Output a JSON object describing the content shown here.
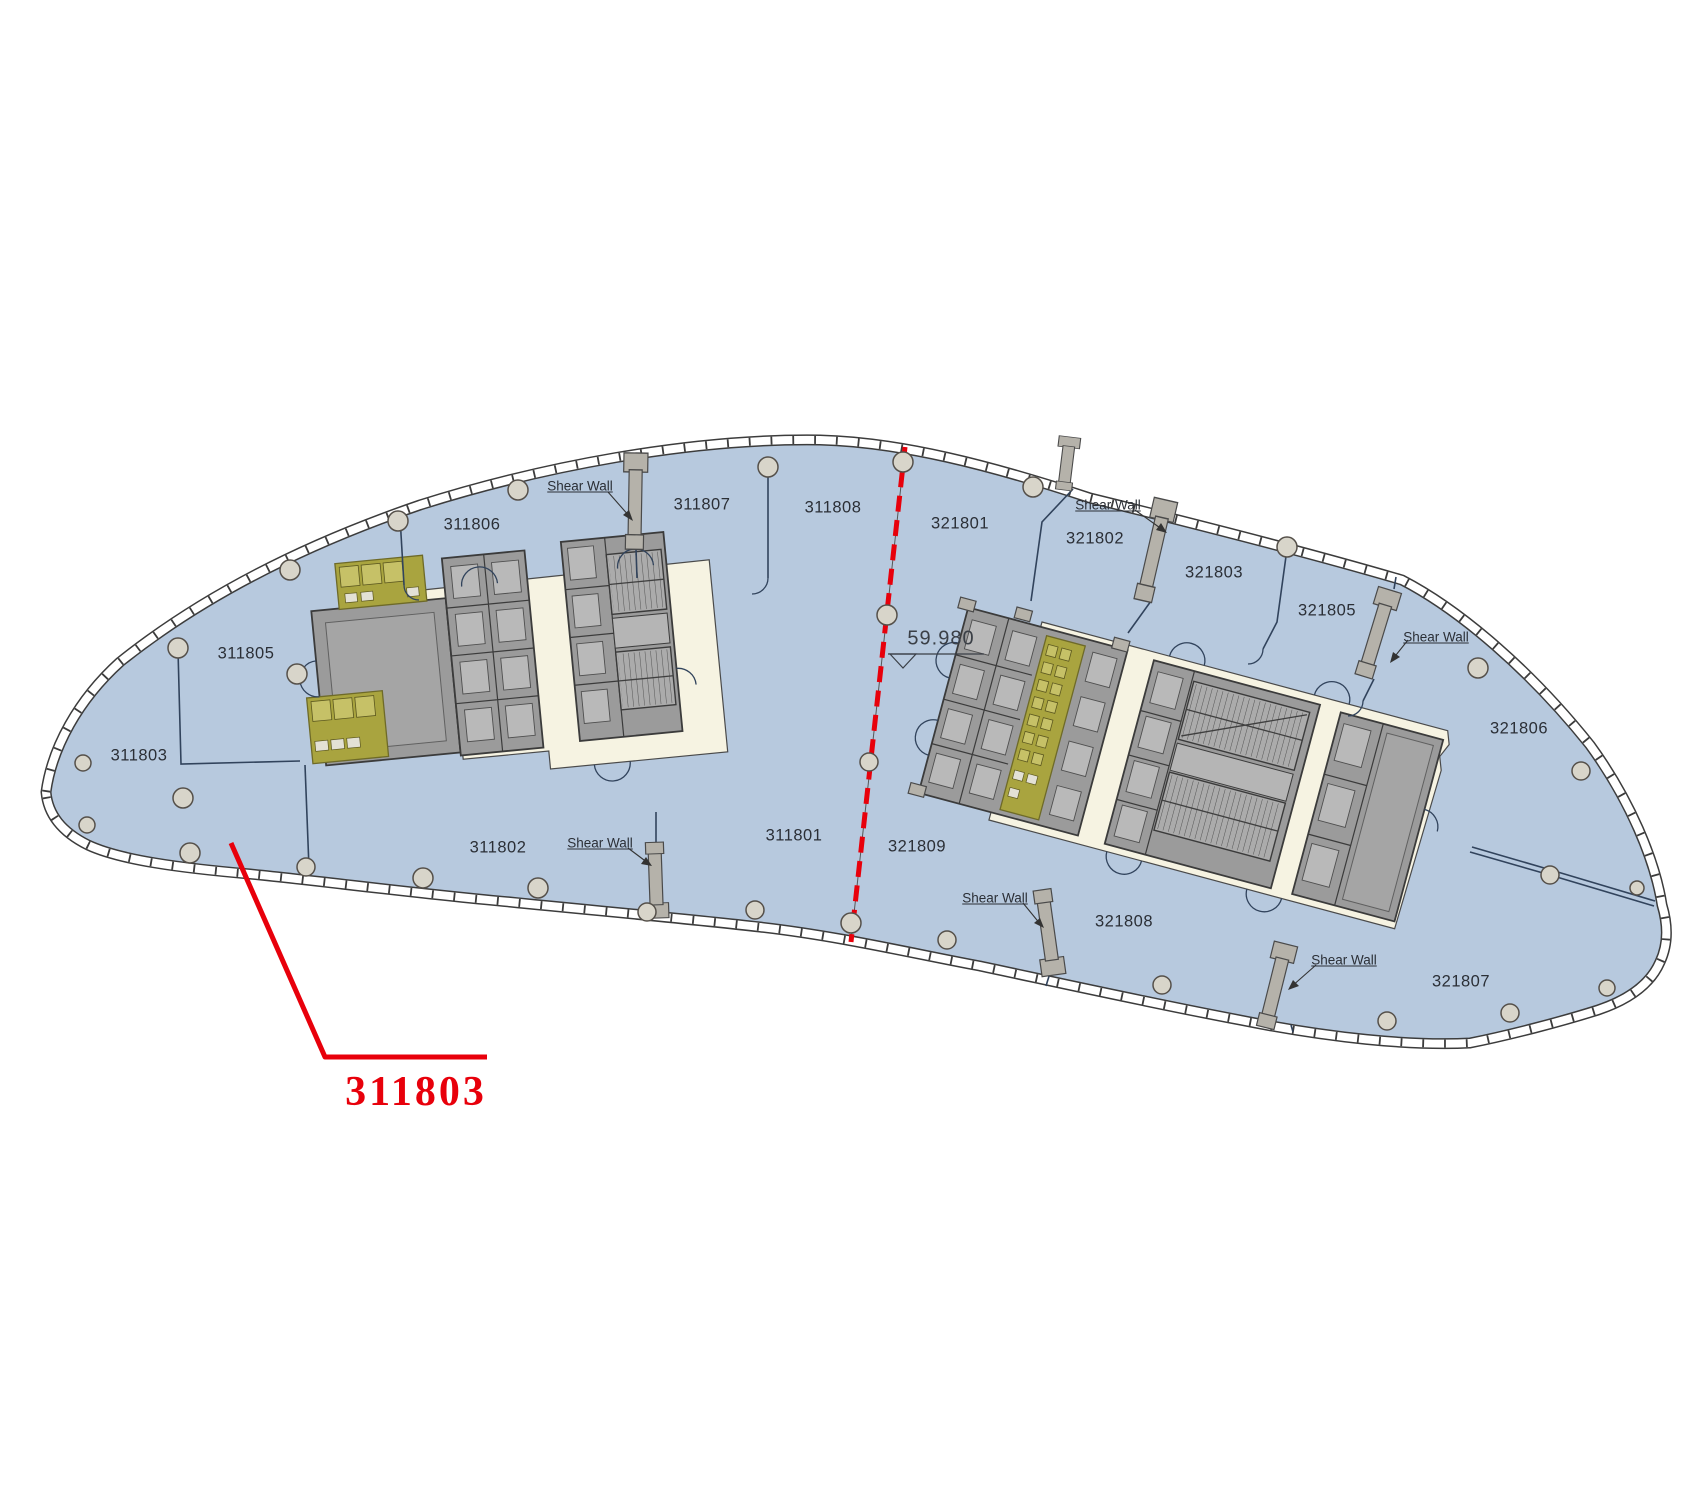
{
  "floor_plan": {
    "units": [
      {
        "id": "311803",
        "x": 139,
        "y": 756
      },
      {
        "id": "311805",
        "x": 246,
        "y": 654
      },
      {
        "id": "311806",
        "x": 472,
        "y": 525
      },
      {
        "id": "311807",
        "x": 702,
        "y": 505
      },
      {
        "id": "311808",
        "x": 833,
        "y": 508
      },
      {
        "id": "311802",
        "x": 498,
        "y": 848
      },
      {
        "id": "311801",
        "x": 794,
        "y": 836
      },
      {
        "id": "321801",
        "x": 960,
        "y": 524
      },
      {
        "id": "321802",
        "x": 1095,
        "y": 539
      },
      {
        "id": "321803",
        "x": 1214,
        "y": 573
      },
      {
        "id": "321805",
        "x": 1327,
        "y": 611
      },
      {
        "id": "321806",
        "x": 1519,
        "y": 729
      },
      {
        "id": "321809",
        "x": 917,
        "y": 847
      },
      {
        "id": "321808",
        "x": 1124,
        "y": 922
      },
      {
        "id": "321807",
        "x": 1461,
        "y": 982
      }
    ],
    "shear_wall_labels": [
      {
        "text": "Shear Wall",
        "x": 580,
        "y": 486
      },
      {
        "text": "Shear Wall",
        "x": 1108,
        "y": 505
      },
      {
        "text": "Shear Wall",
        "x": 1436,
        "y": 637
      },
      {
        "text": "Shear Wall",
        "x": 600,
        "y": 843
      },
      {
        "text": "Shear Wall",
        "x": 995,
        "y": 898
      },
      {
        "text": "Shear Wall",
        "x": 1344,
        "y": 960
      }
    ],
    "level_marker": {
      "value": "59.980",
      "x": 941,
      "y": 639
    },
    "callout": {
      "label": "311803",
      "x": 416,
      "y": 1092
    },
    "colors": {
      "floor": "#b7c9de",
      "facade": "#3c3c3c",
      "core": "#f6f3e2",
      "wall": "#9b9b9b",
      "restroom": "#a9a43f",
      "partition": "#31435c",
      "red": "#e8000b",
      "column": "#d8d5ca"
    }
  }
}
